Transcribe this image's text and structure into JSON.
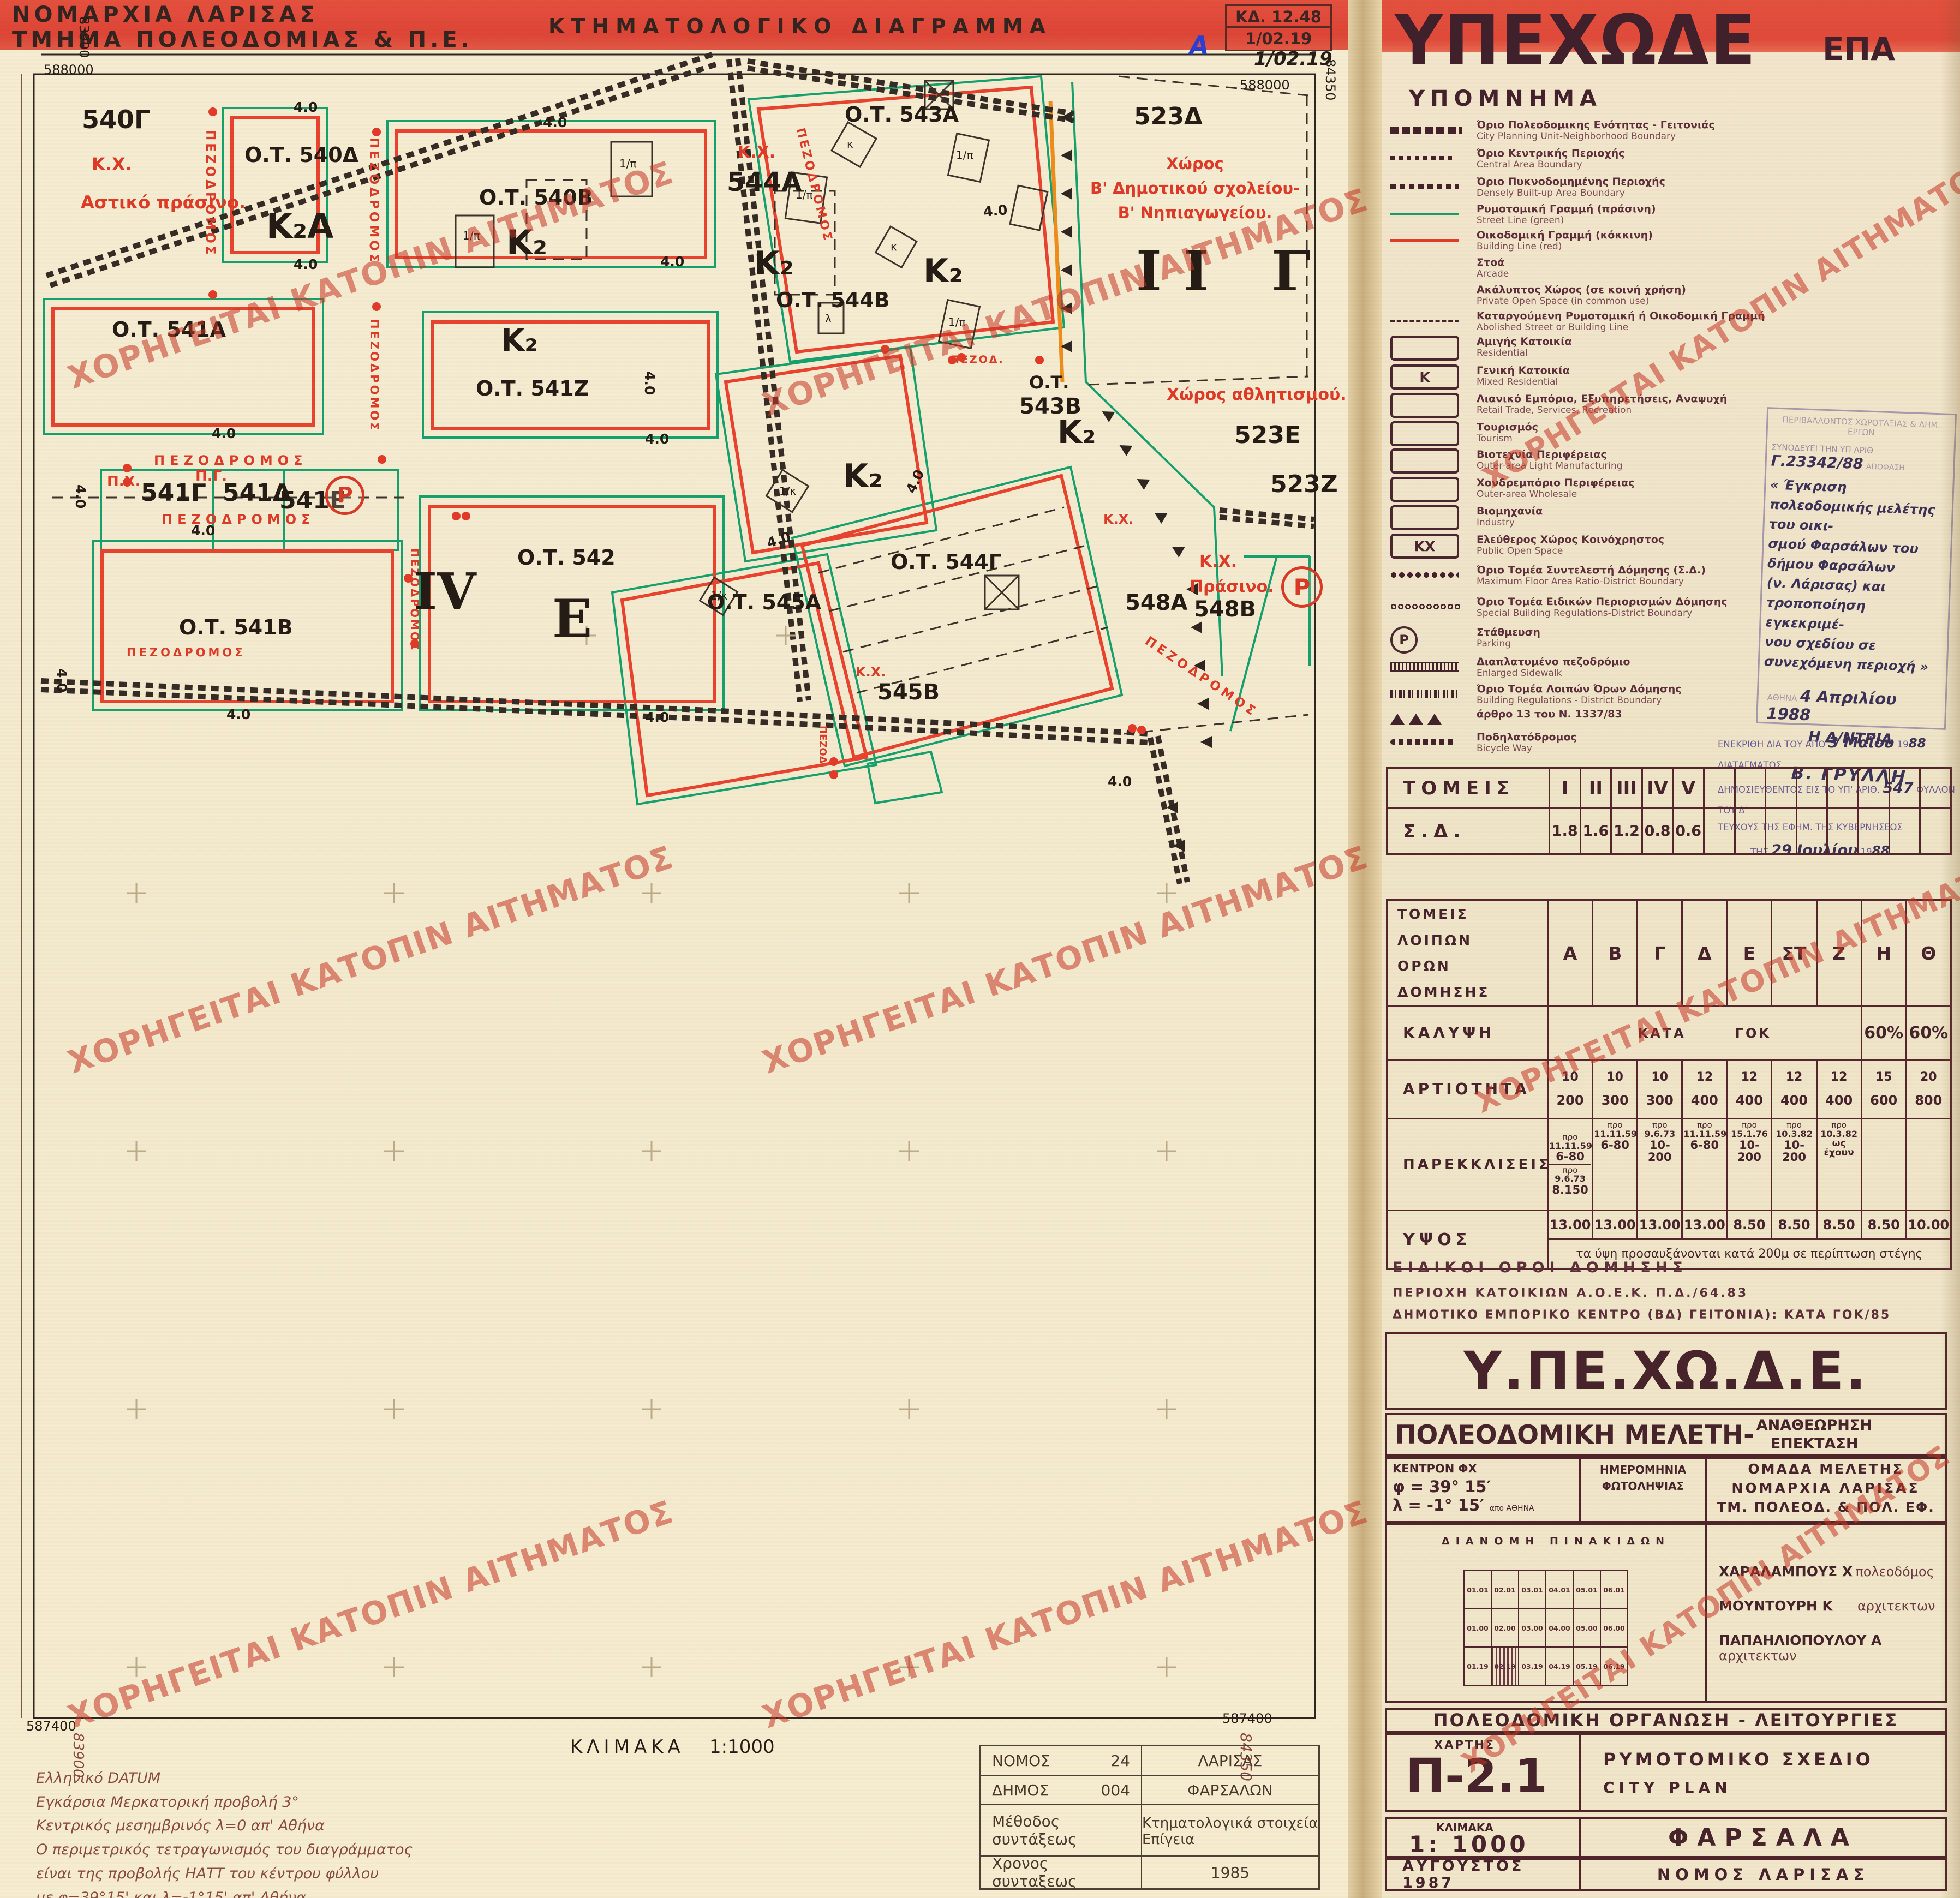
{
  "header": {
    "line1": "ΝΟΜΑΡΧΙΑ ΛΑΡΙΣΑΣ",
    "line2": "ΤΜΗΜΑ ΠΟΛΕΟΔΟΜΙΑΣ & Π.Ε.",
    "title": "ΚΤΗΜΑΤΟΛΟΓΙΚΟ ΔΙΑΓΡΑΜΜΑ",
    "kd_line1": "ΚΔ. 12.48",
    "kd_line2": "1/02.19",
    "annot_letter": "Α",
    "annot_date": "1/02.19"
  },
  "watermark": {
    "text": "ΧΟΡΗΓΕΙΤΑΙ ΚΑΤΟΠΙΝ ΑΙΤΗΜΑΤΟΣ"
  },
  "map": {
    "dim": "4.0",
    "scale_label": "ΚΛΙΜΑΚΑ",
    "scale_value": "1:1000",
    "grid": {
      "n_top": "588000",
      "n_bottom": "587400",
      "e_left": "83900",
      "e_right": "84350"
    },
    "labels": {
      "l540g": "540Γ",
      "kx": "Κ.Χ.",
      "astiko": "Αστικό πράσινο.",
      "pez": "ΠΕΖΟΔΡΟΜΟΣ",
      "pezod": "ΠΕΖΟΔ.",
      "ot540d": "Ο.Τ. 540Δ",
      "k2a": "Κ₂Α",
      "ot540b": "Ο.Τ. 540Β",
      "k2": "Κ₂",
      "ot541a": "Ο.Τ. 541Α",
      "ot541z": "Ο.Τ. 541Ζ",
      "px": "Π.Χ.",
      "pg": "Π.Γ.",
      "l541c": "541Γ",
      "l541d": "541Δ",
      "l541e": "541Ε",
      "ot541b": "Ο.Τ. 541Β",
      "iv": "IV",
      "ot542": "Ο.Τ. 542",
      "e_big": "Ε",
      "ot543a": "Ο.Τ. 543Α",
      "l544a": "544Α",
      "ot544b": "Ο.Τ. 544Β",
      "ot": "Ο.Τ.",
      "l543b": "543Β",
      "sport": "Χώρος αθλητισμού.",
      "l523d": "523Δ",
      "l523e": "523Ε",
      "l523z": "523Ζ",
      "ii_g": "ΙΙ Γ",
      "school1": "Χώρος",
      "school2": "Β' Δημοτικού σχολείου-",
      "school3": "Β' Νηπιαγωγείου.",
      "ot544c": "Ο.Τ. 544Γ",
      "prasino": "Πράσινο.",
      "l548a": "548Α",
      "l548b": "548Β",
      "ot545a": "Ο.Τ. 545Α",
      "l545b": "545Β",
      "b_pi": "1/π",
      "b_k": "κ",
      "b_l": "λ",
      "b_1k": "1/κ",
      "parking_letter": "P"
    },
    "datum_notes": [
      "Ελληνικό  DATUM",
      "Εγκάρσια  Μερκατορική  προβολή  3°",
      "Κεντρικός  μεσημβρινός  λ=0  απ' Αθήνα",
      "Ο περιμετρικός τετραγωνισμός του διαγράμματος",
      "είναι της προβολής ΗΑΤΤ του κέντρου φύλλου",
      "με  φ=39°15' και λ=-1°15'  απ' Αθήνα"
    ],
    "info_table": {
      "nomos_label": "ΝΟΜΟΣ",
      "nomos_code": "24",
      "nomos_name": "ΛΑΡΙΣΑΣ",
      "dimos_label": "ΔΗΜΟΣ",
      "dimos_code": "004",
      "dimos_name": "ΦΑΡΣΑΛΩΝ",
      "method_label": "Μέθοδος συντάξεως",
      "method_value": "Κτηματολογικά στοιχεία Επίγεια",
      "time_label": "Χρονος συνταξεως",
      "time_value": "1985"
    }
  },
  "panel": {
    "ministry": "ΥΠΕΧΩΔΕ",
    "epa": "ΕΠΑ",
    "legend_title": "ΥΠΟΜΝΗΜΑ",
    "legend": [
      {
        "el": "Όριο Πολεοδομικης Ενότητας - Γειτονιάς",
        "en": "City Planning Unit-Neighborhood Boundary"
      },
      {
        "el": "Όριο Κεντρικής Περιοχής",
        "en": "Central Area Boundary"
      },
      {
        "el": "Όριο Πυκνοδομημένης Περιοχής",
        "en": "Densely Built-up Area Boundary"
      },
      {
        "el": "Ρυμοτομική Γραμμή (πράσινη)",
        "en": "Street Line (green)"
      },
      {
        "el": "Οικοδομική Γραμμή (κόκκινη)",
        "en": "Building Line (red)"
      },
      {
        "el": "Στοά",
        "en": "Arcade"
      },
      {
        "el": "Ακάλυπτος Χώρος (σε κοινή χρήση)",
        "en": "Private Open Space (in common use)"
      },
      {
        "el": "Καταργούμενη Ρυμοτομική ή Οικοδομική Γραμμή",
        "en": "Abolished Street or Building Line"
      },
      {
        "el": "Αμιγής Κατοικία",
        "en": "Residential"
      },
      {
        "el": "Γενική Κατοικία",
        "en": "Mixed Residential",
        "tag": "Κ"
      },
      {
        "el": "Λιανικό Εμπόριο, Εξυπηρετήσεις, Αναψυχή",
        "en": "Retail Trade, Services, Recreation"
      },
      {
        "el": "Τουρισμός",
        "en": "Tourism"
      },
      {
        "el": "Βιοτεχνία Περιφέρειας",
        "en": "Outer-area Light Manufacturing"
      },
      {
        "el": "Χονδρεμπόριο Περιφέρειας",
        "en": "Outer-area Wholesale"
      },
      {
        "el": "Βιομηχανία",
        "en": "Industry"
      },
      {
        "el": "Ελεύθερος Χώρος Κοινόχρηστος",
        "en": "Public Open Space",
        "tag": "ΚΧ"
      },
      {
        "el": "Όριο Τομέα Συντελεστή Δόμησης (Σ.Δ.)",
        "en": "Maximum Floor Area Ratio-District Boundary"
      },
      {
        "el": "Όριο Τομέα Ειδικών Περιορισμών Δόμησης",
        "en": "Special Building Regulations-District Boundary"
      },
      {
        "el": "Στάθμευση",
        "en": "Parking",
        "tag": "P"
      },
      {
        "el": "Διαπλατυμένο πεζοδρόμιο",
        "en": "Enlarged Sidewalk"
      },
      {
        "el": "Όριο Τομέα Λοιπών  Όρων Δόμησης",
        "en": "Building Regulations - District Boundary"
      },
      {
        "el": "άρθρο 13 του Ν. 1337/83",
        "en": ""
      },
      {
        "el": "Ποδηλατόδρομος",
        "en": "Bicycle Way"
      }
    ],
    "stamp1": {
      "faded1": "ΠΕΡΙΒΑΛΛΟΝΤΟΣ ΧΩΡΟΤΑΞΙΑΣ & ΔΗΜ. ΕΡΓΩΝ",
      "p1": "ΣΥΝΟΔΕΥΕΙ ΤΗΝ ΥΠ ΑΡΙΘ",
      "h1": "Γ.23342/88",
      "p2": "ΑΠΟΦΑΣΗ",
      "body1": "« Έγκριση πολεοδομικής μελέτης του οικι-",
      "body2": "σμού Φαρσάλων του δήμου Φαρσάλων",
      "body3": "(ν. Λάρισας) και τροποποίηση εγκεκριμέ-",
      "body4": "νου σχεδίου σε συνεχόμενη περιοχή »",
      "athina": "ΑΘΗΝΑ",
      "date": "4 Απριλίου 1988",
      "role": "Η Δ/ΝΤΡΙΑ",
      "name": "Β. ΓΡΥΛΛΗ"
    },
    "stamp2": {
      "p1a": "ΕΝΕΚΡΙΘΗ ΔΙΑ ΤΟΥ ΑΠΟ",
      "h1a": "3 Μαΐου",
      "p1b": "19",
      "h1b": "88",
      "p1c": "ΔΙΑΤΑΓΜΑΤΟΣ",
      "p2a": "ΔΗΜΟΣΙΕΥΘΕΝΤΟΣ ΕΙΣ ΤΟ ΥΠ' ΑΡΙΘ.",
      "h2a": "547",
      "p2b": "ΦΥΛΛΟΝ ΤΟΥ Δ'",
      "p3": "ΤΕΥΧΟΥΣ ΤΗΣ ΕΦΗΜ. ΤΗΣ ΚΥΒΕΡΝΗΣΕΩΣ",
      "p4a": "ΤΗΣ",
      "h4a": "29 Ιουλίου",
      "p4b": "19",
      "h4b": "88"
    },
    "sd_table": {
      "row1_label": "ΤΟΜΕΙΣ",
      "row2_label": "Σ.Δ.",
      "sectors": [
        "I",
        "II",
        "III",
        "IV",
        "V"
      ],
      "values": [
        "1.8",
        "1.6",
        "1.2",
        "0.8",
        "0.6"
      ]
    },
    "build_table": {
      "title1": "ΤΟΜΕΙΣ ΛΟΙΠΩΝ",
      "title2": "ΟΡΩΝ ΔΟΜΗΣΗΣ",
      "cols": [
        "Α",
        "Β",
        "Γ",
        "Δ",
        "Ε",
        "ΣΤ",
        "Ζ",
        "Η",
        "Θ"
      ],
      "kalypsi_label": "ΚΑΛΥΨΗ",
      "kata": "ΚΑΤΑ",
      "gok": "ΓΟΚ",
      "kalypsi_h": "60%",
      "kalypsi_th": "60%",
      "artiotita_label": "ΑΡΤΙΟΤΗΤΑ",
      "artiotita": [
        [
          "10",
          "200"
        ],
        [
          "10",
          "300"
        ],
        [
          "10",
          "300"
        ],
        [
          "12",
          "400"
        ],
        [
          "12",
          "400"
        ],
        [
          "12",
          "400"
        ],
        [
          "12",
          "400"
        ],
        [
          "15",
          "600"
        ],
        [
          "20",
          "800"
        ]
      ],
      "parekklisis_label": "ΠΑΡΕΚΚΛΙΣΕΙΣ",
      "pro": "προ",
      "parekklisis": [
        {
          "date": "11.11.59",
          "val": "6-80"
        },
        {
          "date": "11.11.59",
          "val": "6-80"
        },
        {
          "date": "9.6.73",
          "val": "10-200"
        },
        {
          "date": "11.11.59",
          "val": "6-80"
        },
        {
          "date": "15.1.76",
          "val": "10-200"
        },
        {
          "date": "10.3.82",
          "val": "10-200"
        },
        {
          "date": "10.3.82",
          "val": "ως έχουν"
        }
      ],
      "parekklisis_a2": {
        "date": "9.6.73",
        "val": "8.150"
      },
      "ypsos_label": "ΥΨΟΣ",
      "ypsos": [
        "13.00",
        "13.00",
        "13.00",
        "13.00",
        "8.50",
        "8.50",
        "8.50",
        "8.50",
        "10.00"
      ],
      "ypsos_note": "τα ύψη προσαυξάνονται κατά 200μ σε περίπτωση στέγης"
    },
    "special": {
      "title": "ΕΙΔΙΚΟΙ ΟΡΟΙ ΔΟΜΗΣΗΣ",
      "line1": "ΠΕΡΙΟΧΗ ΚΑΤΟΙΚΙΩΝ Α.Ο.Ε.Κ. Π.Δ./64.83",
      "line2": "ΔΗΜΟΤΙΚΟ ΕΜΠΟΡΙΚΟ ΚΕΝΤΡΟ (ΒΔ) ΓΕΙΤΟΝΙΑ):  ΚΑΤΑ ΓΟΚ/85"
    },
    "titleblock": {
      "ministry": "Υ.ΠΕ.ΧΩ.Δ.Ε.",
      "study": "ΠΟΛΕΟΔΟΜΙΚΗ ΜΕΛΕΤΗ-",
      "rev1": "ΑΝΑΘΕΩΡΗΣΗ",
      "rev2": "ΕΠΕΚΤΑΣΗ",
      "center_label": "ΚΕΝΤΡΟΝ ΦΧ",
      "phi": "φ = 39° 15′",
      "lambda": "λ = -1° 15′",
      "lambda_suffix": "απο ΑΘΗΝΑ",
      "date_label1": "ΗΜΕΡΟΜΗΝΙΑ",
      "date_label2": "ΦΩΤΟΛΗΨΙΑΣ",
      "team_label": "ΟΜΑΔΑ ΜΕΛΕΤΗΣ",
      "team1": "ΝΟΜΑΡΧΙΑ ΛΑΡΙΣΑΣ",
      "team2": "ΤΜ. ΠΟΛΕΟΔ. & ΠΟΛ. ΕΦ.",
      "dianomi": "ΔΙΑΝΟΜΗ ΠΙΝΑΚΙΔΩΝ",
      "grid_cells": [
        [
          "01.01",
          "02.01",
          "03.01",
          "04.01",
          "05.01",
          "06.01"
        ],
        [
          "01.00",
          "02.00",
          "03.00",
          "04.00",
          "05.00",
          "06.00"
        ],
        [
          "01.19",
          "02.19",
          "03.19",
          "04.19",
          "05.19",
          "06.19"
        ]
      ],
      "members": [
        {
          "name": "ΧΑΡΑΛΑΜΠΟΥΣ  Χ",
          "role": "πολεοδόμος"
        },
        {
          "name": "ΜΟΥΝΤΟΥΡΗ  Κ",
          "role": "αρχιτεκτων"
        },
        {
          "name": "ΠΑΠΑΗΛΙΟΠΟΥΛΟΥ  Α",
          "role": "αρχιτεκτων"
        }
      ],
      "org_title": "ΠΟΛΕΟΔΟΜΙΚΗ  ΟΡΓΑΝΩΣΗ  -  ΛΕΙΤΟΥΡΓΙΕΣ",
      "chart_label": "ΧΑΡΤΗΣ",
      "chart_no": "Π-2.1",
      "plan_el": "ΡΥΜΟΤΟΜΙΚΟ ΣΧΕΔΙΟ",
      "plan_en": "CITY PLAN",
      "scale_label": "ΚΛΙΜΑΚΑ",
      "scale": "1: 1000",
      "city": "ΦΑΡΣΑΛΑ",
      "date": "ΑΥΓΟΥΣΤΟΣ 1987",
      "prefecture": "ΝΟΜΟΣ ΛΑΡΙΣΑΣ"
    }
  }
}
